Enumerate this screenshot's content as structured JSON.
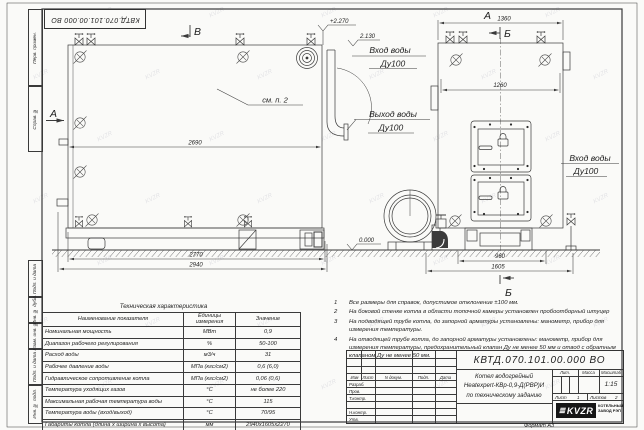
{
  "watermark": {
    "text": "KVZR"
  },
  "margin_labels": [
    "Перв. примен.",
    "Справ. №",
    "Подп. и дата",
    "Инв. № дубл.",
    "Взам. инв. №",
    "Подп. и дата",
    "Инв. № подл."
  ],
  "drawing": {
    "view_a": "А",
    "view_b": "Б",
    "view_v": "В",
    "see_note": "см. п. 2",
    "dim_2690": "2690",
    "dim_2770": "2770",
    "dim_2940": "2940",
    "dim_1360": "1360",
    "dim_1260": "1260",
    "dim_960": "960",
    "dim_1605": "1605",
    "elev_top": "+2.270",
    "elev_pipe": "2.130",
    "elev_zero": "0.000",
    "inlet_label": "Вход воды",
    "outlet_label": "Выход воды",
    "dn_label": "Ду100"
  },
  "notes": {
    "items": [
      {
        "num": "1",
        "text": "Все размеры для справок, допустимое отклонение ±100 мм."
      },
      {
        "num": "2",
        "text": "На боковой стенке котла в области топочной камеры установлен пробоотборный штуцер"
      },
      {
        "num": "3",
        "text": "На подводящей трубе котла, до запорной арматуры установлены: манометр, прибор для измерения температуры."
      },
      {
        "num": "4",
        "text": "На отводящей трубе котла, до запорной арматуры установлены: манометр, прибор для измерения температуры, предохранительный клапан Ду не менее 50 мм и отвод с обратным клапаном Ду не менее 50 мм."
      }
    ]
  },
  "table": {
    "title": "Техническая характеристика",
    "headers": {
      "name": "Наименование показателя",
      "unit1": "Единицы",
      "unit2": "измерения",
      "value": "Значение"
    },
    "rows": [
      {
        "name": "Номинальная мощность",
        "unit": "МВт",
        "value": "0,9"
      },
      {
        "name": "Диапазон рабочего регулирования",
        "unit": "%",
        "value": "50-100"
      },
      {
        "name": "Расход воды",
        "unit": "м3/ч",
        "value": "31"
      },
      {
        "name": "Рабочее давление воды",
        "unit": "МПа (кгс/см2)",
        "value": "0,6 (6,0)"
      },
      {
        "name": "Гидравлическое сопротивление котла",
        "unit": "МПа (кгс/см2)",
        "value": "0,06 (0,6)"
      },
      {
        "name": "Температура уходящих газов",
        "unit": "°С",
        "value": "не более 220"
      },
      {
        "name": "Максимальная рабочая температура воды",
        "unit": "°С",
        "value": "115"
      },
      {
        "name": "Температура воды (вход/выход)",
        "unit": "°С",
        "value": "70/95"
      },
      {
        "name": "Габариты котла (длина х ширина х высота)",
        "unit": "мм",
        "value": "2940х1605х2270"
      }
    ]
  },
  "title_block": {
    "doc_number": "КВТД.070.101.00.000  ВО",
    "product_line1": "Котел водогрейный",
    "product_line2": "Heatexpert-КВр-0,9-Д(РВР)И",
    "product_line3": "по техническому заданию",
    "col_izm": "Изм",
    "col_list": "Лист",
    "col_ndoc": "N докум.",
    "col_podp": "Подп.",
    "col_data": "Дата",
    "row_razrab": "Разраб.",
    "row_prov": "Пров.",
    "row_tkontr": "Т.контр.",
    "row_nkontr": "Н.контр.",
    "row_utv": "Утв.",
    "lit": "Лит.",
    "massa": "Масса",
    "masshtab": "Масштаб",
    "scale": "1:15",
    "sheet_label": "Лист",
    "sheet": "1",
    "sheets_label": "Листов",
    "sheets": "2",
    "company_logo": "KVZR",
    "company_line1": "КОТЕЛЬНЫЙ",
    "company_line2": "ЗАВОД РЭП",
    "format": "Формат  А3"
  }
}
